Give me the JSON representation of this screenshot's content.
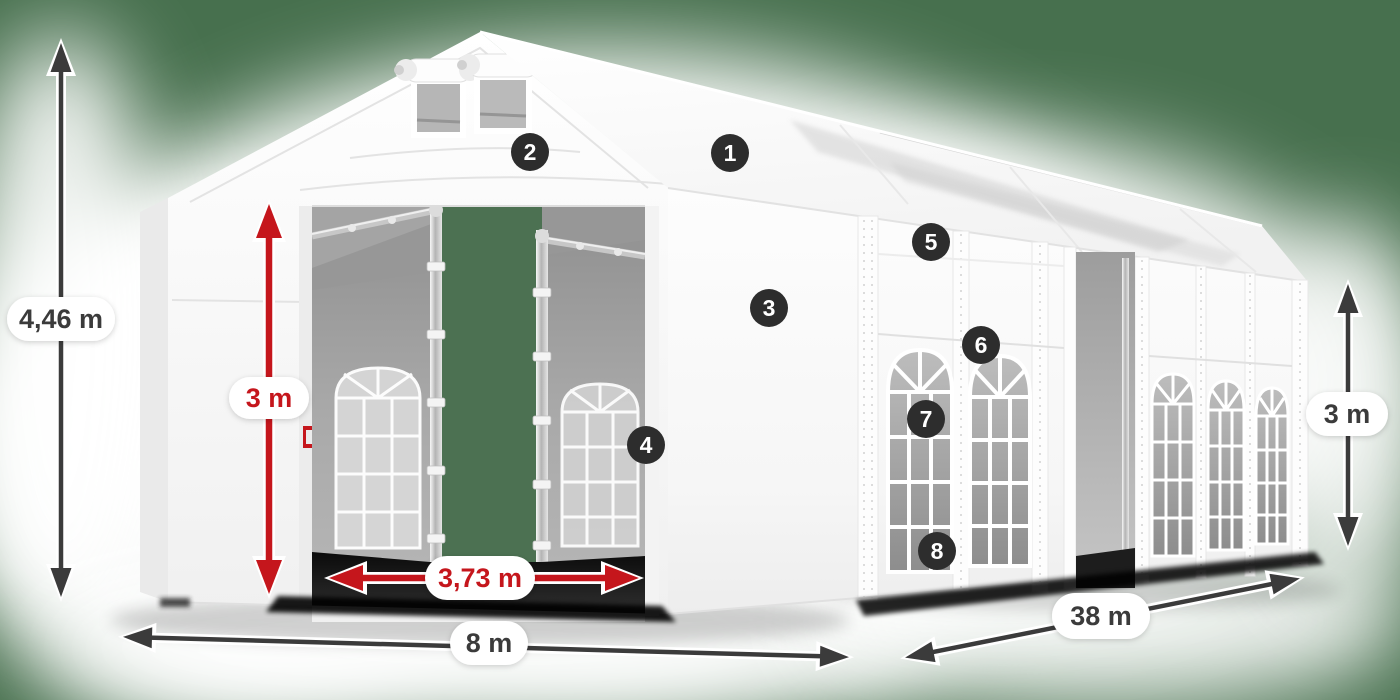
{
  "scene": {
    "description": "3D product render of a white marquee party tent shown from the front-left corner, annotated with dimension arrows and numbered feature markers",
    "background_color": "#47704E",
    "tent_color": "#FFFFFF",
    "doorway_view_color": "#4C7152",
    "shadow_color": "#0A0A0A"
  },
  "dimensions": {
    "total_height": {
      "label": "4,46 m",
      "style": "dark",
      "color": "#3B3B3B",
      "meaning": "total ridge height"
    },
    "inner_height": {
      "label": "3 m",
      "style": "red",
      "color": "#C5161C",
      "meaning": "entrance / side clearance height"
    },
    "entrance_width": {
      "label": "3,73 m",
      "style": "red",
      "color": "#C5161C",
      "meaning": "entrance door width"
    },
    "front_width": {
      "label": "8 m",
      "style": "dark",
      "color": "#3B3B3B",
      "meaning": "tent gable width"
    },
    "side_length": {
      "label": "38 m",
      "style": "dark",
      "color": "#3B3B3B",
      "meaning": "tent side length"
    },
    "side_height": {
      "label": "3 m",
      "style": "dark",
      "color": "#3B3B3B",
      "meaning": "side wall height"
    }
  },
  "feature_markers": [
    {
      "number": "1"
    },
    {
      "number": "2"
    },
    {
      "number": "3"
    },
    {
      "number": "4"
    },
    {
      "number": "5"
    },
    {
      "number": "6"
    },
    {
      "number": "7"
    },
    {
      "number": "8"
    }
  ],
  "colors": {
    "badge": "#2D2D2D",
    "badge_text": "#FFFFFF",
    "label_pill": "#FFFFFF",
    "arrow_dark": "#3B3B3B",
    "arrow_red": "#C5161C"
  }
}
